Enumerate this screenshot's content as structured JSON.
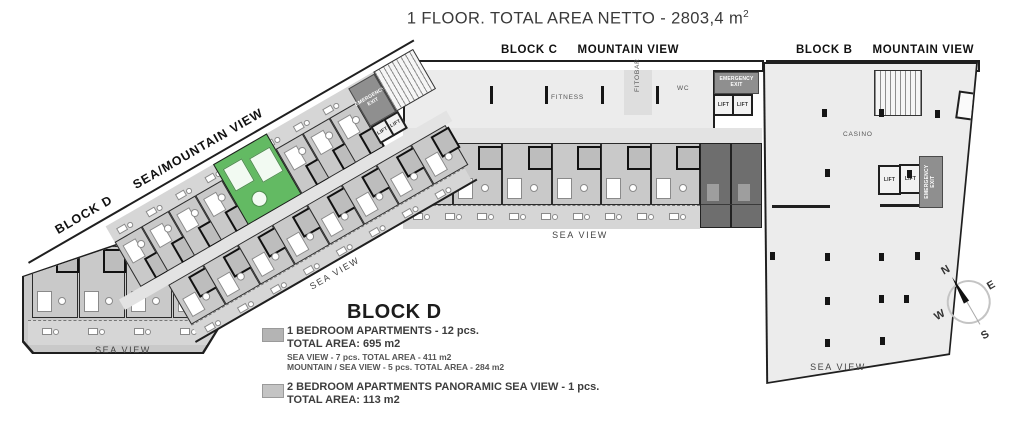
{
  "title": {
    "text": "1 FLOOR. TOTAL AREA NETTO - 2803,4 m",
    "sup": "2"
  },
  "blocks": {
    "c": {
      "name": "BLOCK C",
      "view_label": "MOUNTAIN VIEW",
      "fitness": "FITNESS",
      "fitobar": "FITOBAR",
      "wc": "WC"
    },
    "b": {
      "name": "BLOCK B",
      "view_label": "MOUNTAIN VIEW",
      "casino": "CASINO"
    },
    "d": {
      "name": "BLOCK D",
      "view_label": "SEA/MOUNTAIN VIEW"
    }
  },
  "labels": {
    "sea_view": "SEA VIEW",
    "lift": "LIFT",
    "emergency_exit": "EMERGENCY EXIT"
  },
  "legend": {
    "heading": "BLOCK D",
    "items": [
      {
        "swatch": "#b4b4b4",
        "title": "1 BEDROOM APARTMENTS - 12 pcs.",
        "total": "TOTAL AREA: 695 m2",
        "details": [
          "SEA VIEW - 7 pcs. TOTAL AREA - 411 m2",
          "MOUNTAIN / SEA VIEW - 5 pcs. TOTAL AREA - 284 m2"
        ]
      },
      {
        "swatch": "#c4c4c4",
        "title": "2 BEDROOM APARTMENTS PANORAMIC SEA VIEW - 1 pcs.",
        "total": "TOTAL AREA: 113 m2",
        "details": []
      }
    ]
  },
  "compass": {
    "n": "N",
    "e": "E",
    "s": "S",
    "w": "W"
  },
  "colors": {
    "highlight": "#63ba63",
    "apartment": "#c9c9c9",
    "floor": "#ececec",
    "dark_room": "#6e6e6e",
    "wall": "#1f1f1f"
  }
}
